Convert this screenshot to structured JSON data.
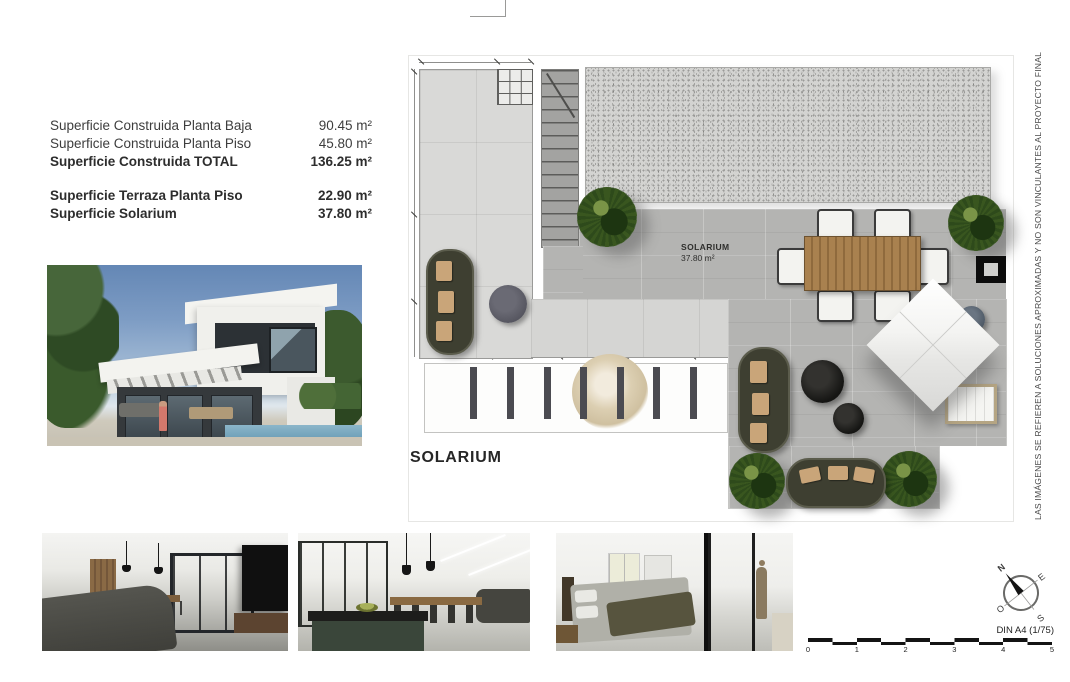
{
  "surface_table": {
    "rows": [
      {
        "label": "Superficie Construida Planta Baja",
        "value": "90.45 m²"
      },
      {
        "label": "Superficie Construida Planta Piso",
        "value": "45.80 m²"
      },
      {
        "label": "Superficie Construida TOTAL",
        "value": "136.25 m²"
      },
      {
        "label": "Superficie Terraza Planta Piso",
        "value": "22.90 m²"
      },
      {
        "label": "Superficie Solarium",
        "value": "37.80 m²"
      }
    ]
  },
  "plan": {
    "room_label": "SOLARIUM",
    "room_area": "37.80 m²",
    "caption": "SOLARIUM"
  },
  "disclaimer": "LAS IMÁGENES SE REFIEREN A SOLUCIONES APROXIMADAS Y NO SON VINCULANTES AL PROYECTO FINAL",
  "compass": {
    "north": "N",
    "east": "E",
    "south": "S",
    "west": "O"
  },
  "scale_bar": {
    "label": "DIN A4 (1/75)",
    "ticks": [
      "0",
      "1",
      "2",
      "3",
      "4",
      "5"
    ]
  },
  "photos": {
    "exterior": "exterior-villa-render",
    "living": "living-room-render",
    "kitchen": "kitchen-render",
    "bedroom": "bedroom-render"
  },
  "colors": {
    "solarium_tile": "#b4b4b2",
    "terrace_tile": "#d9d9d7",
    "plant_green": "#39561f",
    "wood_brown": "#a9814f",
    "accent_black": "#0c0c0c"
  }
}
